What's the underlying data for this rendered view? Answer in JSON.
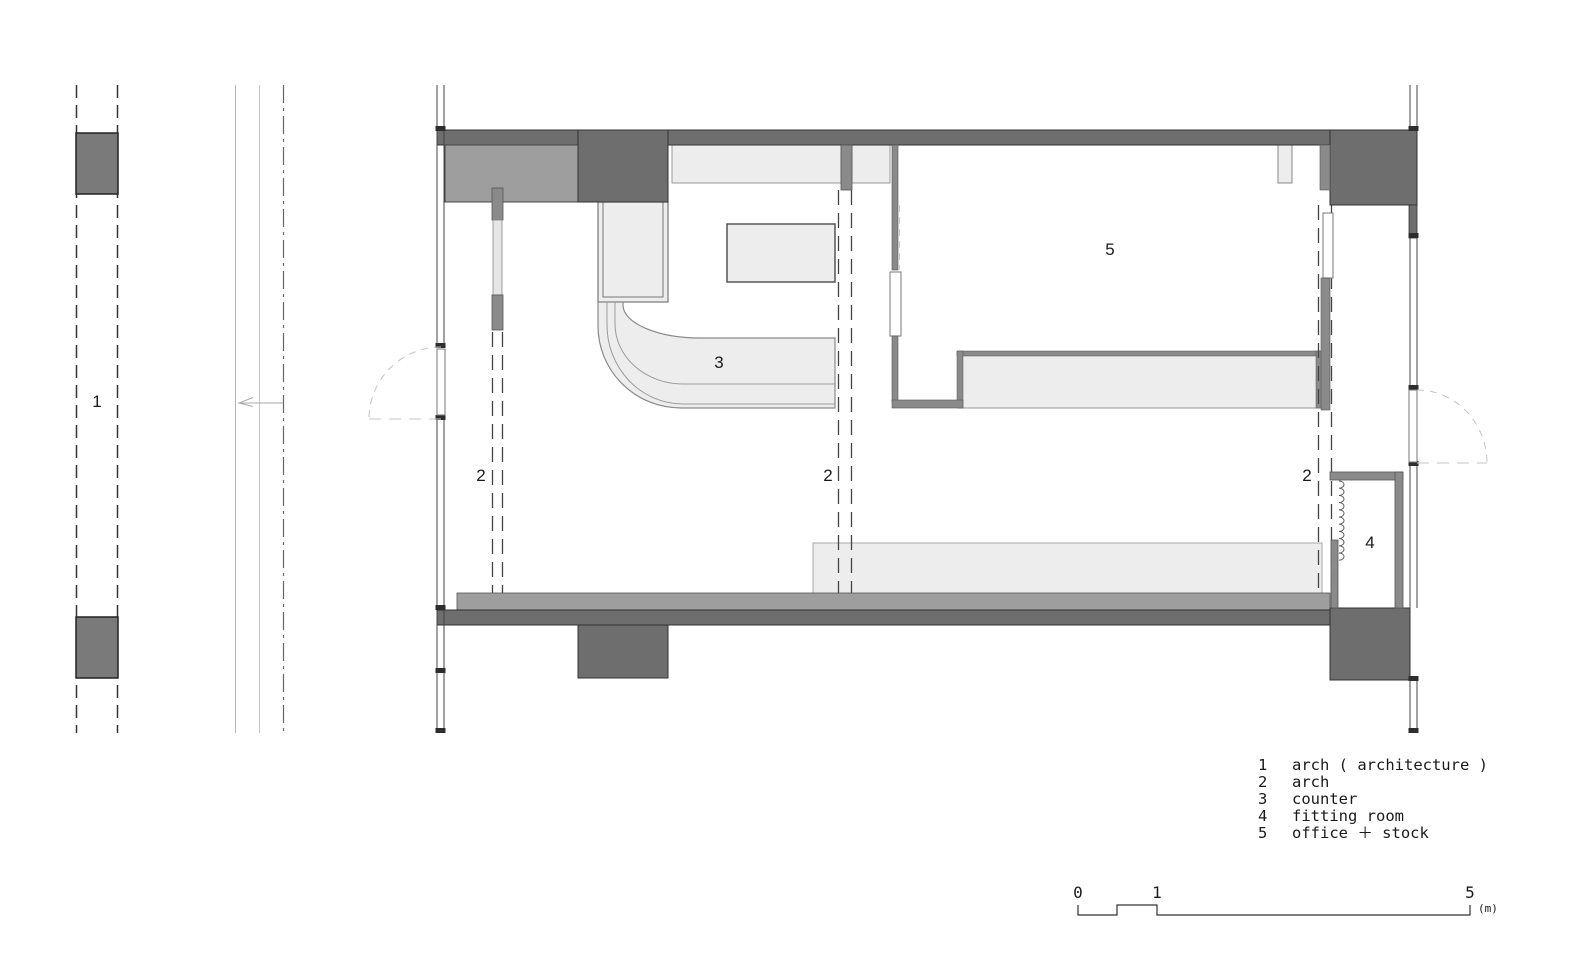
{
  "plan": {
    "labels": {
      "arch_corridor": "1",
      "arch": "2",
      "counter": "3",
      "fitting_room": "4",
      "office_stock": "5"
    }
  },
  "legend": {
    "items": [
      {
        "number": "1",
        "label": "arch ( architecture )"
      },
      {
        "number": "2",
        "label": "arch"
      },
      {
        "number": "3",
        "label": "counter"
      },
      {
        "number": "4",
        "label": "fitting room"
      },
      {
        "number": "5",
        "label": "office ＋ stock"
      }
    ]
  },
  "scale_bar": {
    "tick_0": "0",
    "tick_1": "1",
    "tick_5": "5",
    "unit": "(m)"
  },
  "colors": {
    "wall_dark": "#6e6e6e",
    "wall_medium": "#9e9e9e",
    "wall_gray": "#8a8a8a",
    "fill_light": "#ededed",
    "line_dark": "#333333",
    "swing_dashed": "#c4c4c4"
  }
}
